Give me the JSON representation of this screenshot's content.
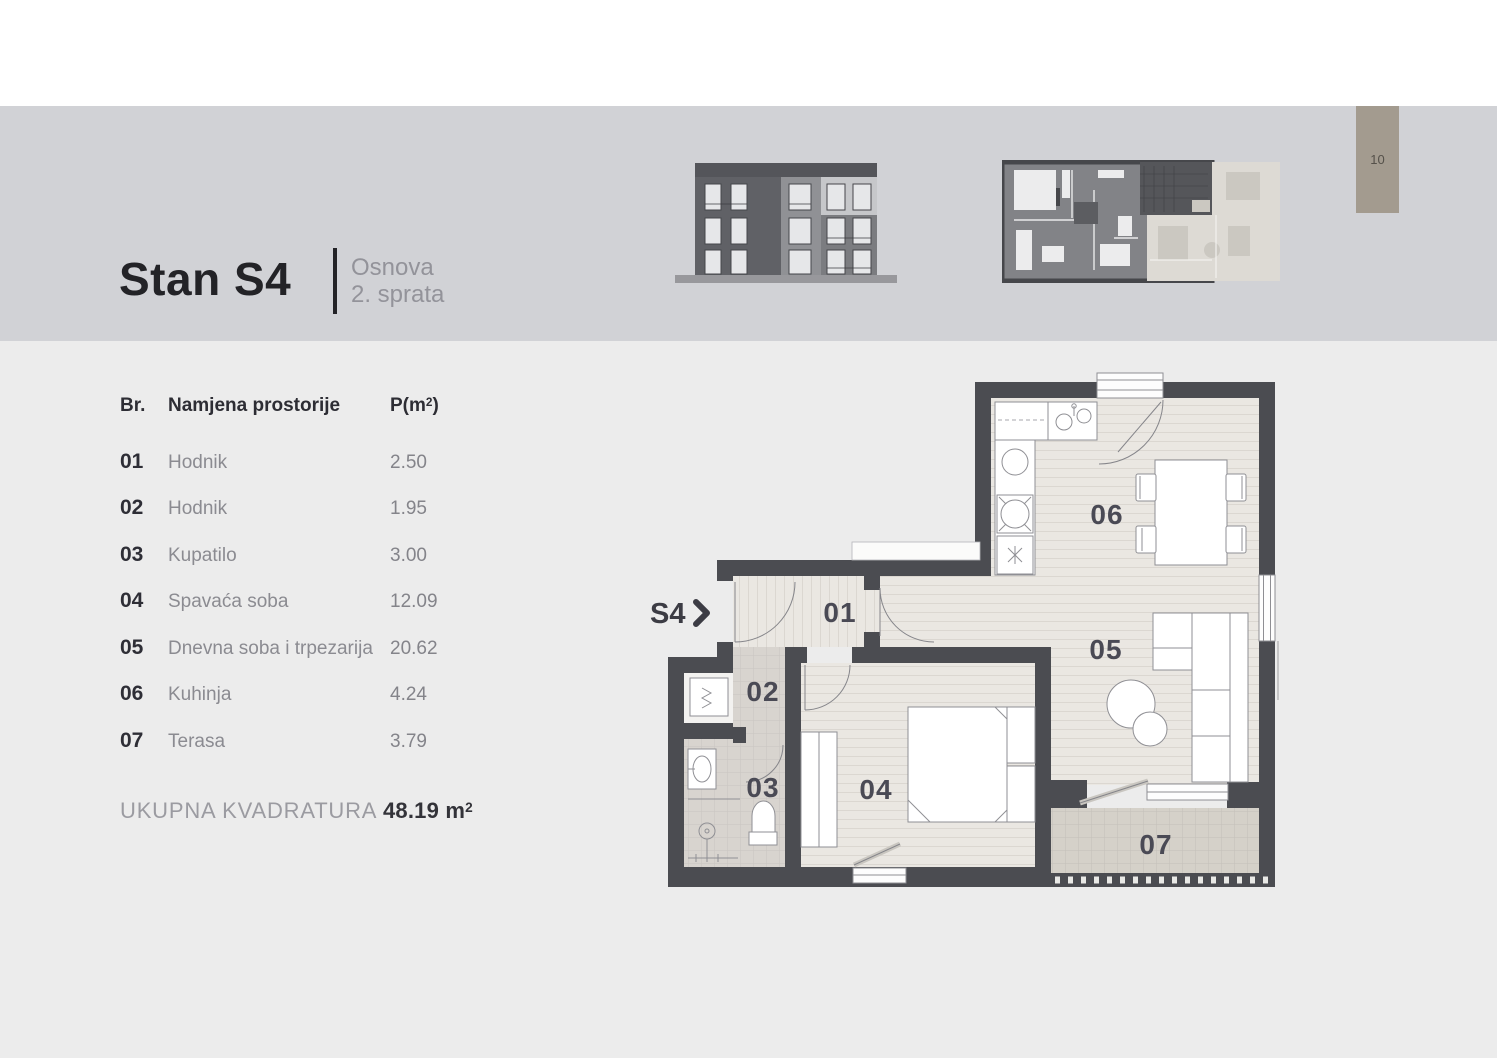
{
  "page": {
    "number": "10"
  },
  "header": {
    "title": "Stan S4",
    "subtitle_line1": "Osnova",
    "subtitle_line2": "2. sprata"
  },
  "table": {
    "col_br": "Br.",
    "col_name": "Namjena prostorije",
    "col_area_prefix": "P(m",
    "col_area_sup": "2",
    "col_area_suffix": ")",
    "rows": [
      {
        "id": "01",
        "name": "Hodnik",
        "area": "2.50"
      },
      {
        "id": "02",
        "name": "Hodnik",
        "area": "1.95"
      },
      {
        "id": "03",
        "name": "Kupatilo",
        "area": "3.00"
      },
      {
        "id": "04",
        "name": "Spavaća soba",
        "area": "12.09"
      },
      {
        "id": "05",
        "name": "Dnevna soba i trpezarija",
        "area": "20.62"
      },
      {
        "id": "06",
        "name": "Kuhinja",
        "area": "4.24"
      },
      {
        "id": "07",
        "name": "Terasa",
        "area": "3.79"
      }
    ]
  },
  "total": {
    "label": "UKUPNA KVADRATURA",
    "value": "48.19 m",
    "sup": "2"
  },
  "plan": {
    "entrance_label": "S4",
    "room_labels": {
      "r01": "01",
      "r02": "02",
      "r03": "03",
      "r04": "04",
      "r05": "05",
      "r06": "06",
      "r07": "07"
    }
  },
  "colors": {
    "band": "#d1d2d6",
    "page_tab": "#a39b8f",
    "wall": "#4b4c51",
    "floor_plank": "#eae7e2",
    "floor_tile": "#d8d4cf",
    "floor_terrace": "#d5d1c9",
    "title_text": "#232327"
  }
}
